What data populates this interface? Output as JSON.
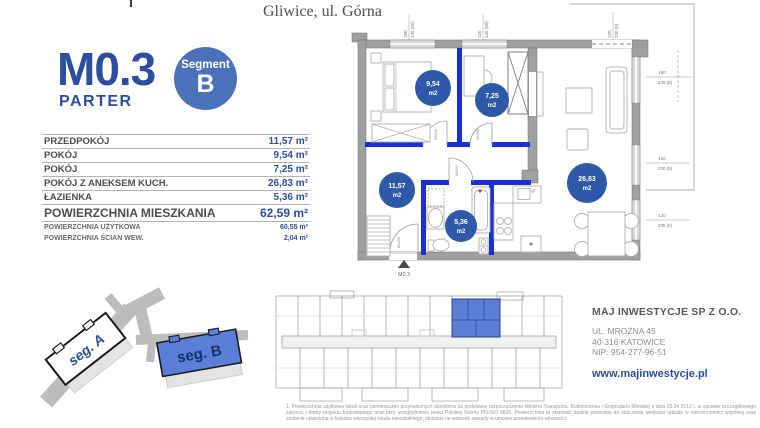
{
  "header": {
    "location": "Gliwice, ul. Górna"
  },
  "unit": {
    "code": "M0.3",
    "level": "PARTER",
    "segment_word": "Segment",
    "segment_letter": "B"
  },
  "area_table": {
    "rows": [
      {
        "label": "PRZEDPOKÓJ",
        "value": "11,57 m²"
      },
      {
        "label": "POKÓJ",
        "value": "9,54 m²"
      },
      {
        "label": "POKÓJ",
        "value": "7,25 m²"
      },
      {
        "label": "POKÓJ Z ANEKSEM KUCH.",
        "value": "26,83 m²"
      },
      {
        "label": "ŁAZIENKA",
        "value": "5,36 m²"
      }
    ],
    "total": {
      "label": "POWIERZCHNIA MIESZKANIA",
      "value": "62,59 m²"
    },
    "sub_rows": [
      {
        "label": "POWIERZCHNIA UŻYTKOWA",
        "value": "60,55 m²"
      },
      {
        "label": "POWIERZCHNIA ŚCIAN WEW.",
        "value": "2,04 m²"
      }
    ]
  },
  "floor_plan": {
    "room_areas": [
      {
        "value": "9,54",
        "unit": "m2"
      },
      {
        "value": "7,25",
        "unit": "m2"
      },
      {
        "value": "11,57",
        "unit": "m2"
      },
      {
        "value": "5,36",
        "unit": "m2"
      },
      {
        "value": "26,83",
        "unit": "m2"
      }
    ],
    "entrance_label": "M0.3",
    "dims": [
      {
        "a": "180",
        "b": "145 (80)"
      },
      {
        "a": "120",
        "b": "145 (80)"
      },
      {
        "a": "120",
        "b": "230 (0)"
      },
      {
        "a": "180",
        "b": "230 (0)"
      },
      {
        "a": "120",
        "b": "230 (0)"
      },
      {
        "a": "120",
        "b": "230 (0)"
      }
    ],
    "door_dim": "80/200"
  },
  "site_map": {
    "segment_a": "seg. A",
    "segment_b": "seg. B"
  },
  "company": {
    "name": "MAJ INWESTYCJE SP Z O.O.",
    "address_line1": "UL. MROŹNA 45",
    "address_line2": "40-316 KATOWICE",
    "nip": "NIP: 954-277-96-51",
    "website": "www.majinwestycje.pl"
  },
  "colors": {
    "brand_blue": "#2b4f9e",
    "badge_blue": "#4b72b8",
    "wall_blue": "#1b2fd6",
    "highlight_blue": "#5b7fd6"
  },
  "footnote": "1. Powierzchnia użytkowa lokali oraz pomieszczeń przynależnych określona na podstawie rozporządzenia Ministra Transportu, Budownictwa i Gospodarki Morskiej z dnia 25.04.2012 r. w sprawie szczegółowego zakresu i formy projektu budowlanego oraz przy uwzględnieniu treści Polskiej Normy PN-ISO 9836. Powierzchnia ta stanowić będzie podstawę do obliczenia wielkości udziału w nieruchomości wspólnej oraz zostanie ujawniona w księdze wieczystej lokalu mieszkalnego, złożonej na wniosek zawarty w umowie przeniesienia własności."
}
